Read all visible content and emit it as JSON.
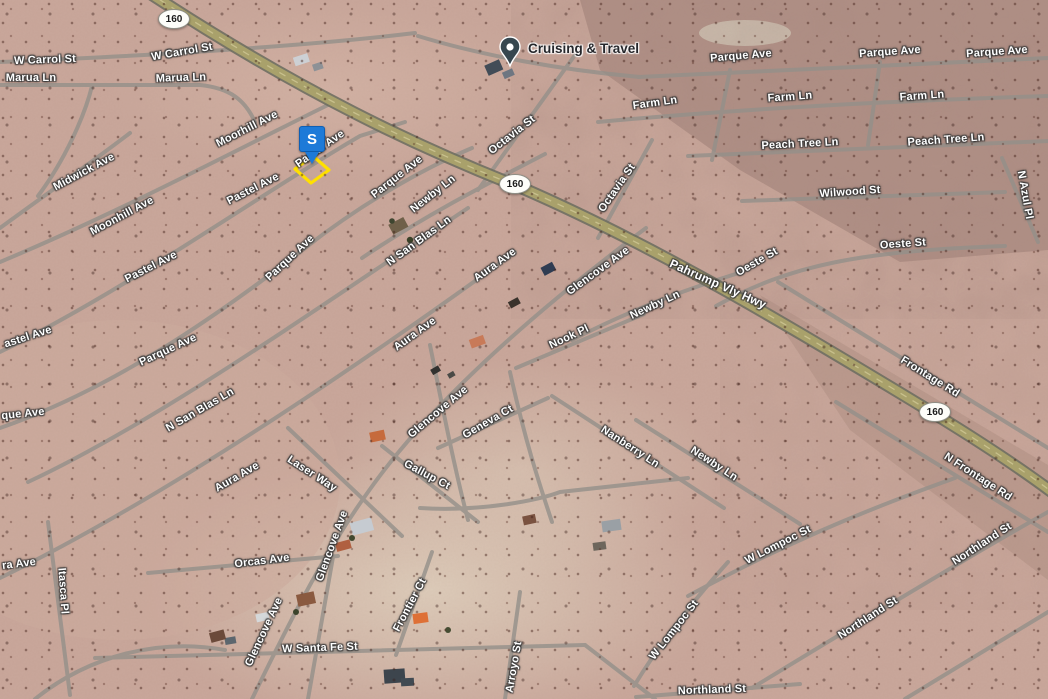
{
  "app": {
    "type": "satellite-map-view",
    "location": "Pahrump Valley area"
  },
  "poi": {
    "name": "Cruising & Travel"
  },
  "selection_marker": {
    "letter": "S"
  },
  "route_shields": [
    {
      "label": "160",
      "x": 174,
      "y": 19
    },
    {
      "label": "160",
      "x": 515,
      "y": 184
    },
    {
      "label": "160",
      "x": 935,
      "y": 412
    }
  ],
  "street_labels": [
    {
      "t": "W Carrol St",
      "x": 45,
      "y": 60,
      "r": -2
    },
    {
      "t": "W Carrol St",
      "x": 182,
      "y": 52,
      "r": -10
    },
    {
      "t": "Marua Ln",
      "x": 31,
      "y": 78,
      "r": 0
    },
    {
      "t": "Marua Ln",
      "x": 181,
      "y": 78,
      "r": -2
    },
    {
      "t": "Moorhill Ave",
      "x": 247,
      "y": 129,
      "r": -27
    },
    {
      "t": "Midwick Ave",
      "x": 84,
      "y": 172,
      "r": -28
    },
    {
      "t": "Moonhill Ave",
      "x": 122,
      "y": 216,
      "r": -28
    },
    {
      "t": "Pastel Ave",
      "x": 253,
      "y": 189,
      "r": -27
    },
    {
      "t": "Pastel Ave",
      "x": 151,
      "y": 267,
      "r": -27
    },
    {
      "t": "Pastel Ave",
      "x": 320,
      "y": 149,
      "r": -35
    },
    {
      "t": "Parque Ave",
      "x": 290,
      "y": 258,
      "r": -43
    },
    {
      "t": "astel Ave",
      "x": 28,
      "y": 337,
      "r": -18
    },
    {
      "t": "Parque Ave",
      "x": 168,
      "y": 350,
      "r": -25
    },
    {
      "t": "que Ave",
      "x": 23,
      "y": 414,
      "r": -6
    },
    {
      "t": "N San Blas Ln",
      "x": 200,
      "y": 410,
      "r": -30
    },
    {
      "t": "Parque Ave",
      "x": 397,
      "y": 177,
      "r": -38
    },
    {
      "t": "Newby Ln",
      "x": 433,
      "y": 194,
      "r": -38
    },
    {
      "t": "N San Blas Ln",
      "x": 419,
      "y": 241,
      "r": -36
    },
    {
      "t": "Octavia St",
      "x": 512,
      "y": 135,
      "r": -38
    },
    {
      "t": "Octavia St",
      "x": 617,
      "y": 188,
      "r": -55
    },
    {
      "t": "Pahrump Vly Hwy",
      "x": 718,
      "y": 284,
      "r": 24,
      "s": 12
    },
    {
      "t": "Oeste St",
      "x": 757,
      "y": 262,
      "r": -30
    },
    {
      "t": "Oeste St",
      "x": 903,
      "y": 244,
      "r": -4
    },
    {
      "t": "Wilwood St",
      "x": 850,
      "y": 192,
      "r": -4
    },
    {
      "t": "N Azul Pl",
      "x": 1025,
      "y": 195,
      "r": 80
    },
    {
      "t": "Parque Ave",
      "x": 741,
      "y": 56,
      "r": -5
    },
    {
      "t": "Parque Ave",
      "x": 890,
      "y": 52,
      "r": -4
    },
    {
      "t": "Parque Ave",
      "x": 997,
      "y": 52,
      "r": -4
    },
    {
      "t": "Farm Ln",
      "x": 655,
      "y": 103,
      "r": -8
    },
    {
      "t": "Farm Ln",
      "x": 790,
      "y": 97,
      "r": -4
    },
    {
      "t": "Farm Ln",
      "x": 922,
      "y": 96,
      "r": -4
    },
    {
      "t": "Peach Tree Ln",
      "x": 800,
      "y": 144,
      "r": -3
    },
    {
      "t": "Peach Tree Ln",
      "x": 946,
      "y": 140,
      "r": -4
    },
    {
      "t": "Glencove Ave",
      "x": 598,
      "y": 271,
      "r": -36
    },
    {
      "t": "Newby Ln",
      "x": 655,
      "y": 305,
      "r": -25
    },
    {
      "t": "Nook Pl",
      "x": 569,
      "y": 337,
      "r": -25
    },
    {
      "t": "Aura Ave",
      "x": 495,
      "y": 265,
      "r": -36
    },
    {
      "t": "Aura Ave",
      "x": 415,
      "y": 334,
      "r": -36
    },
    {
      "t": "Aura Ave",
      "x": 237,
      "y": 477,
      "r": -30
    },
    {
      "t": "Glencove Ave",
      "x": 438,
      "y": 412,
      "r": -40
    },
    {
      "t": "Geneva Ct",
      "x": 488,
      "y": 422,
      "r": -30
    },
    {
      "t": "Nanberry Ln",
      "x": 630,
      "y": 447,
      "r": 33
    },
    {
      "t": "Newby Ln",
      "x": 714,
      "y": 464,
      "r": 33
    },
    {
      "t": "Gallup Ct",
      "x": 427,
      "y": 475,
      "r": 28
    },
    {
      "t": "Laser Way",
      "x": 312,
      "y": 474,
      "r": 33
    },
    {
      "t": "Orcas Ave",
      "x": 262,
      "y": 561,
      "r": -7
    },
    {
      "t": "Glencove Ave",
      "x": 332,
      "y": 546,
      "r": -70
    },
    {
      "t": "Glencove Ave",
      "x": 264,
      "y": 632,
      "r": -65
    },
    {
      "t": "Frontier Ct",
      "x": 410,
      "y": 605,
      "r": -62
    },
    {
      "t": "W Santa Fe St",
      "x": 320,
      "y": 648,
      "r": -2
    },
    {
      "t": "Arroyo St",
      "x": 514,
      "y": 667,
      "r": -80
    },
    {
      "t": "W Lompoc St",
      "x": 778,
      "y": 545,
      "r": -27
    },
    {
      "t": "W Lompoc St",
      "x": 674,
      "y": 630,
      "r": -52
    },
    {
      "t": "Northland St",
      "x": 712,
      "y": 690,
      "r": -2
    },
    {
      "t": "Northland St",
      "x": 868,
      "y": 618,
      "r": -33
    },
    {
      "t": "Northland St",
      "x": 982,
      "y": 544,
      "r": -33
    },
    {
      "t": "Frontage Rd",
      "x": 930,
      "y": 377,
      "r": 32
    },
    {
      "t": "N Frontage Rd",
      "x": 978,
      "y": 477,
      "r": 33
    },
    {
      "t": "Itasca Pl",
      "x": 63,
      "y": 591,
      "r": 86
    },
    {
      "t": "ra Ave",
      "x": 19,
      "y": 564,
      "r": -7
    }
  ],
  "colors": {
    "terrain_base": "#c9a79b",
    "terrain_dark_northeast": "#8f7168",
    "terrain_light_center": "#dcccb8",
    "highway_fill": "#a9a16b",
    "road_gray": "#94908a",
    "marker_blue": "#1d7ad8",
    "parcel_outline_yellow": "#ffe000",
    "poi_pin": "#37474f",
    "label_text": "#ffffff"
  }
}
